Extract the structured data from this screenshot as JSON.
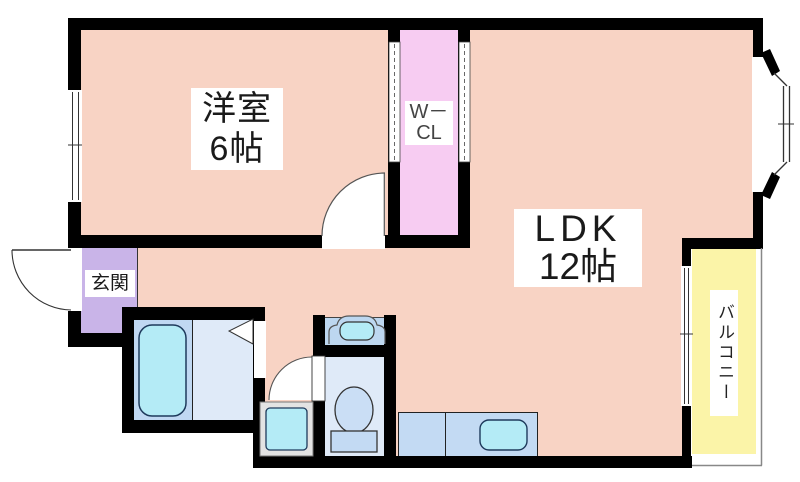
{
  "plan_title": "apartment-floor-plan",
  "rooms": {
    "western_room": {
      "name": "洋室",
      "size": "6帖"
    },
    "walk_in_closet": {
      "line1": "W－",
      "line2": "CL"
    },
    "ldk": {
      "name": "LDK",
      "size": "12帖"
    },
    "entrance": {
      "label": "玄関"
    },
    "balcony": {
      "label": "バルコニー"
    }
  },
  "colors": {
    "wall": "#000000",
    "room_pink": "#f8d3c4",
    "closet_pink": "#f7ccf2",
    "entrance_purple": "#c9b4e8",
    "balcony_yellow": "#fbf4a8",
    "bath_blue": "#c0d8f2",
    "light_blue": "#dfeaf8",
    "basin_blue": "#bdd7f0",
    "counter_blue": "#c3daf3",
    "fixture_cyan": "#b4ebf6",
    "washer_pan_grey": "#e3e3e3"
  },
  "fixtures": {
    "bathtub": "rounded-rect",
    "washbasin": "arch-with-oval",
    "toilet": "ellipse-with-tank",
    "washing_machine_pan": "framed-square",
    "kitchen_counter": "rect-with-sink",
    "kitchen_sink": "rounded-rect",
    "entrance_door": "quarter-arc",
    "room_door": "quarter-arc",
    "toilet_door": "quarter-arc",
    "folding_door": "triangle",
    "closet_sliding_doors": "dashed-strip",
    "window": "double-line",
    "bay_window": "angled-double-line",
    "sliding_glass_door": "double-line",
    "balcony_railing": "thin-line"
  }
}
